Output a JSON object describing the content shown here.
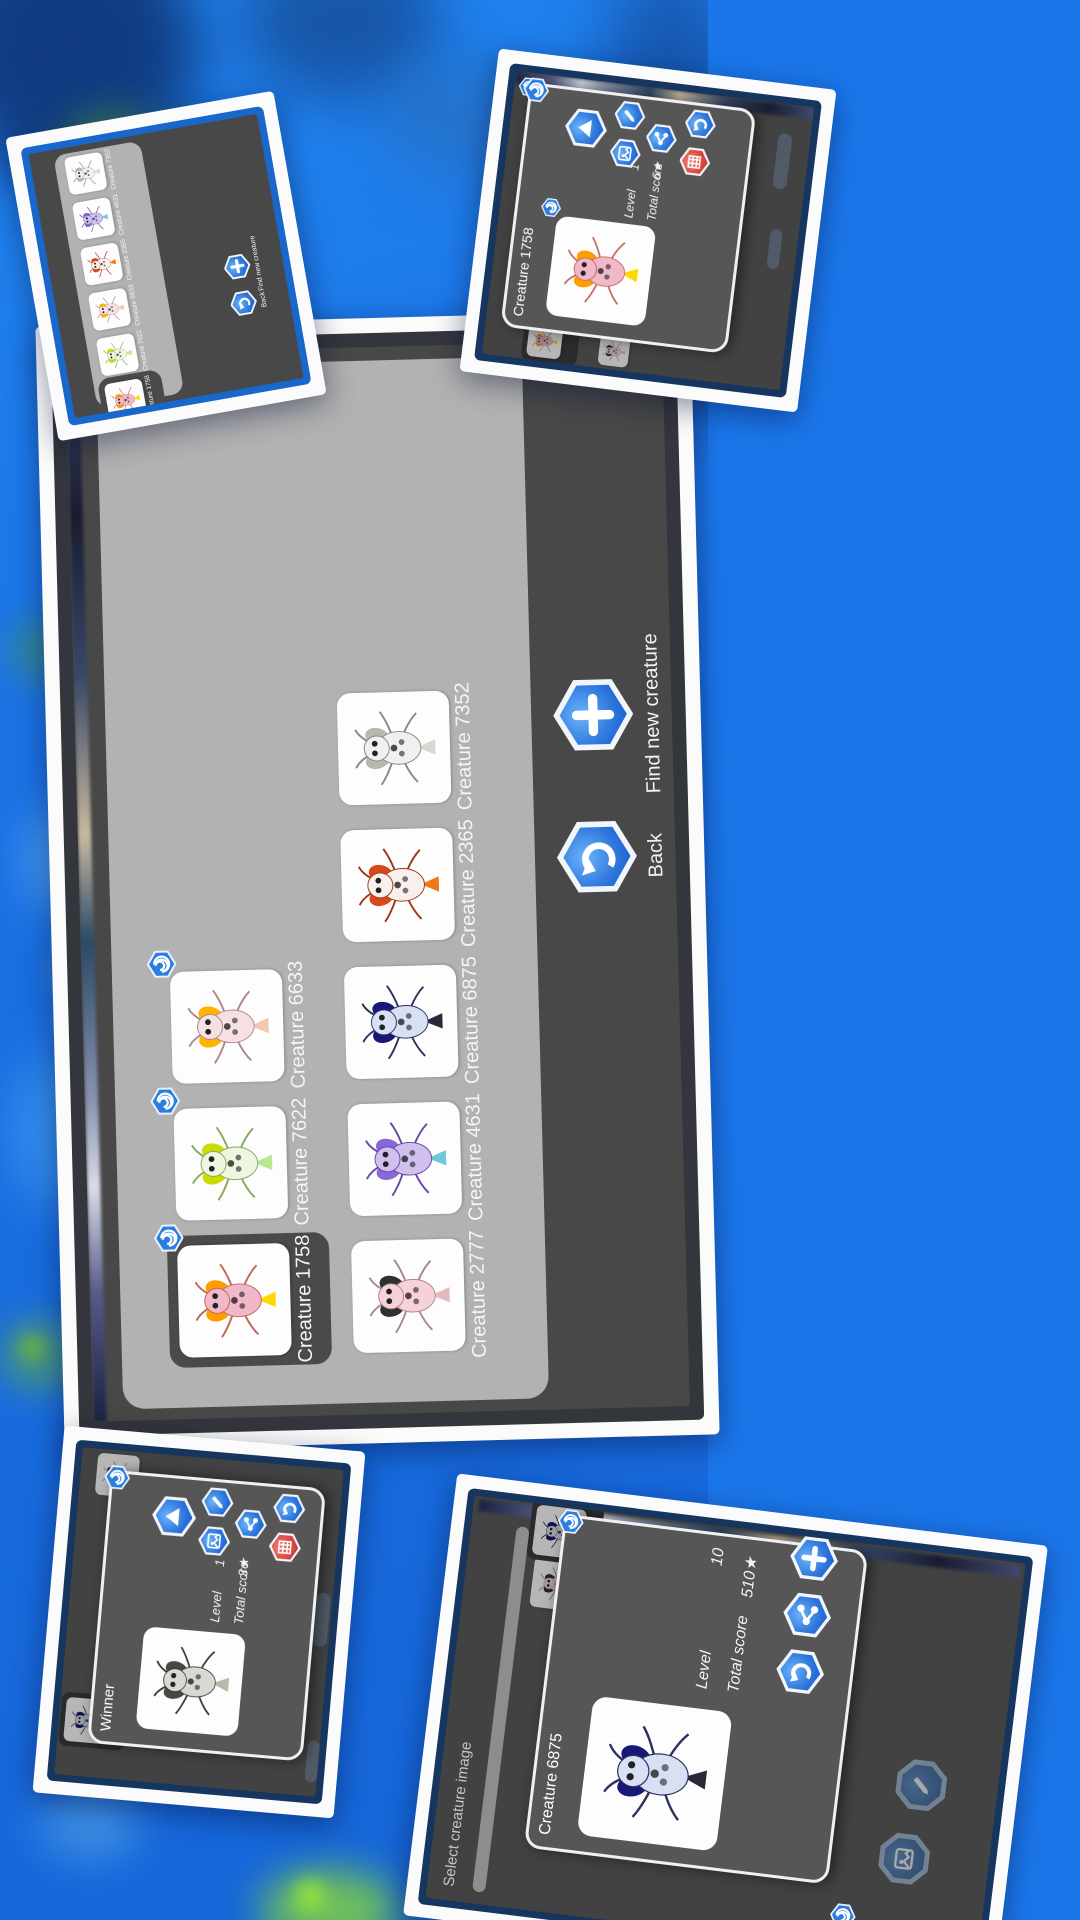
{
  "labels": {
    "back": "Back",
    "find_new_creature": "Find new creature",
    "level": "Level",
    "total_score": "Total score",
    "star": "★",
    "select_creature_image": "Select creature image"
  },
  "collection": {
    "selected": "Creature 1758",
    "row1": [
      "Creature 1758",
      "Creature 7622",
      "Creature 6633"
    ],
    "row2": [
      "Creature 2777",
      "Creature 4631",
      "Creature 6875",
      "Creature 2365",
      "Creature 7352"
    ]
  },
  "mini_collection": {
    "cards": [
      "Creature 1758",
      "Creature 7622",
      "Creature 6633",
      "Creature 2365",
      "Creature 4631",
      "Creature 7352"
    ]
  },
  "dialog_1758": {
    "title": "Creature 1758",
    "level_value": "1",
    "score_value": "6"
  },
  "dialog_winner": {
    "title": "Winner",
    "level_value": "1",
    "score_value": "3"
  },
  "dialog_6875": {
    "title": "Creature 6875",
    "level_value": "10",
    "score_value": "510"
  },
  "colors": {
    "bg_blue": "#1b76ea",
    "hex_blue": "#1a5fd0",
    "hex_red": "#d84840",
    "screen_dark": "#484848",
    "panel_gray": "#b2b2b2",
    "selected_gray": "#4a4a4a",
    "badge_blue": "#2b7de0"
  },
  "creatures": {
    "Creature 1758": {
      "body": "#f0b8c8",
      "accent": "#ff9d00",
      "tail": "#ffd800",
      "line": "#c06858"
    },
    "Creature 7622": {
      "body": "#eef6e0",
      "accent": "#cbdc00",
      "tail": "#b8e890",
      "line": "#88a860"
    },
    "Creature 6633": {
      "body": "#f6e0e4",
      "accent": "#ffb300",
      "tail": "#f0c8b0",
      "line": "#b08888"
    },
    "Creature 2777": {
      "body": "#f6d2d8",
      "accent": "#303030",
      "tail": "#e8b8c0",
      "line": "#aa8888"
    },
    "Creature 4631": {
      "body": "#cfc0ee",
      "accent": "#8868d8",
      "tail": "#70c8d8",
      "line": "#6848a8"
    },
    "Creature 6875": {
      "body": "#d8e0f4",
      "accent": "#181878",
      "tail": "#282838",
      "line": "#303060"
    },
    "Creature 2365": {
      "body": "#f8f0ec",
      "accent": "#d84818",
      "tail": "#f07818",
      "line": "#a03818"
    },
    "Creature 7352": {
      "body": "#f0f0ee",
      "accent": "#b8b8b0",
      "tail": "#d8d8d0",
      "line": "#888888"
    },
    "Winner": {
      "body": "#d8d8d4",
      "accent": "#484840",
      "tail": "#b8b8a8",
      "line": "#383830"
    }
  }
}
